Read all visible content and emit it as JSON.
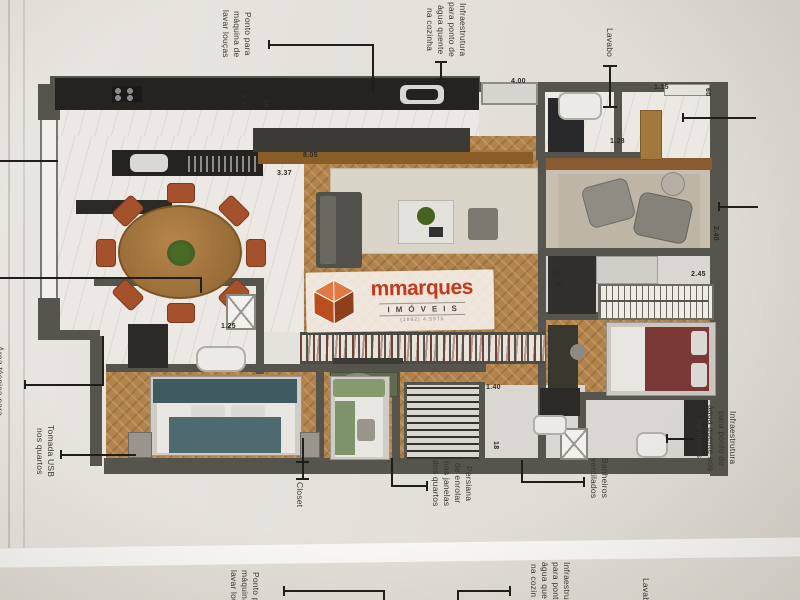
{
  "photo": {
    "paper_color": "#e4e1db",
    "next_page_color": "#e1ded7",
    "gap_color": "#f8f7f4",
    "wall_color": "#55544d",
    "wood_color": "#b2834b",
    "marble_color": "#ece9e4"
  },
  "watermark": {
    "brand": "mmarques",
    "brand_sub": "IMÓVEIS",
    "fine_print": "(1892) 4.5975",
    "brand_color": "#c13a1b"
  },
  "annotations": [
    {
      "id": "ponto-maquina-lavar",
      "text": "Ponto para\nmáquina de\nlavar louças"
    },
    {
      "id": "infra-agua-cozinha",
      "text": "Infraestrutura\npara ponto de\nágua quente\nna cozinha"
    },
    {
      "id": "lavabo",
      "text": "Lavabo"
    },
    {
      "id": "area-tecnica",
      "text": "Área técnica para"
    },
    {
      "id": "tomada-usb",
      "text": "Tomada USB\nnos quartos"
    },
    {
      "id": "closet",
      "text": "Closet"
    },
    {
      "id": "persiana",
      "text": "Persiana\nde enrolar\nnas janelas\ndos quartos"
    },
    {
      "id": "banheiros-ventilados",
      "text": "Banheiros\nventilados"
    },
    {
      "id": "infra-agua-banheiros",
      "text": "Infraestrutura\npara ponto de\nágua quente nos\nbanheiros"
    }
  ],
  "next_page_annotations": [
    {
      "id": "np-ponto-maquina",
      "text": "Ponto p\nmáquina\nlavar lou"
    },
    {
      "id": "np-infra-cozinha",
      "text": "Infraestru\npara pont\nágua que\nna cozin"
    },
    {
      "id": "np-lavabo",
      "text": "Lavabo"
    }
  ],
  "dimensions": [
    {
      "text": "2.77"
    },
    {
      "text": "18"
    },
    {
      "text": "8.05"
    },
    {
      "text": "3.37"
    },
    {
      "text": "4.00"
    },
    {
      "text": "1.15"
    },
    {
      "text": "60"
    },
    {
      "text": "1.28"
    },
    {
      "text": "2.45"
    },
    {
      "text": "18"
    },
    {
      "text": "3.40"
    },
    {
      "text": "2.40"
    },
    {
      "text": "1.25"
    },
    {
      "text": "1.40"
    },
    {
      "text": "18"
    }
  ]
}
